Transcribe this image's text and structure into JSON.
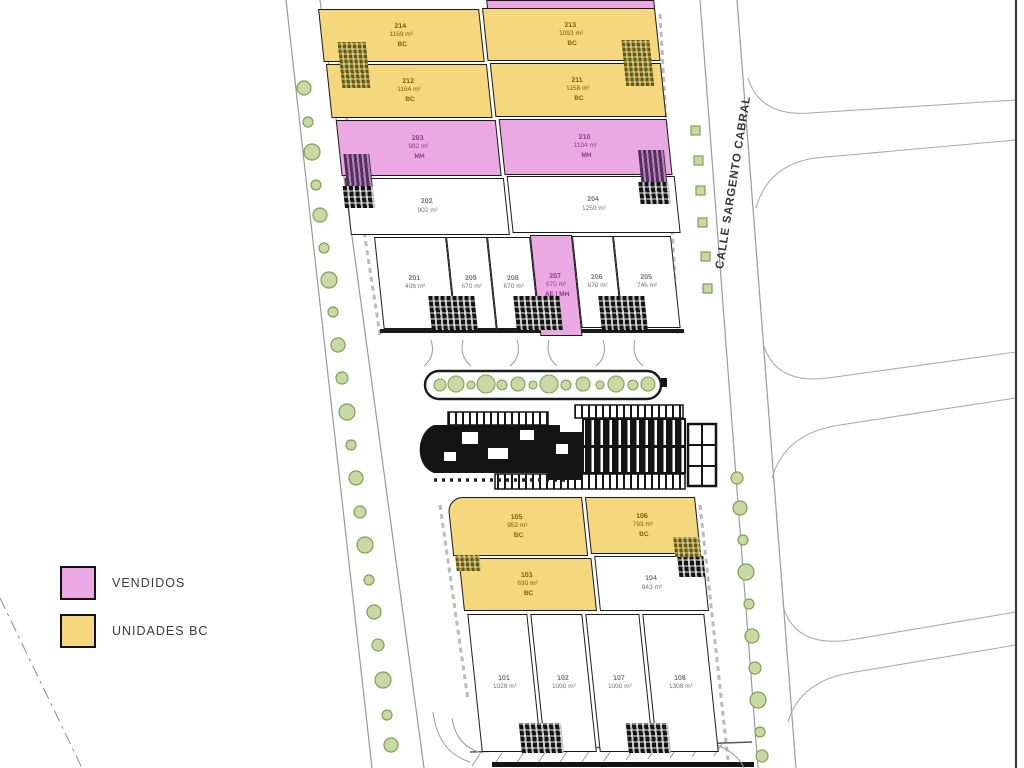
{
  "legend": {
    "items": [
      {
        "label": "VENDIDOS",
        "color": "#EAA9E3"
      },
      {
        "label": "UNIDADES BC",
        "color": "#F5D87D"
      }
    ]
  },
  "streets": {
    "calle": "CALLE SARGENTO CABRAL"
  },
  "colors": {
    "sold": "#EAA9E3",
    "bc_unit": "#F5D87D",
    "tree": "#C9D9A4",
    "line": "#999999"
  },
  "north": {
    "yellow_top": [
      {
        "number": "214",
        "area": "1169 m²",
        "cls": "BC"
      },
      {
        "number": "213",
        "area": "1093 m²",
        "cls": "BC"
      }
    ],
    "yellow_mid": [
      {
        "number": "212",
        "area": "1164 m²",
        "cls": "BC"
      },
      {
        "number": "211",
        "area": "1158 m²",
        "cls": "BC"
      }
    ],
    "pink": [
      {
        "number": "203",
        "area": "982 m²",
        "cls": "MH"
      },
      {
        "number": "210",
        "area": "1104 m²",
        "cls": "MH"
      }
    ],
    "white": [
      {
        "number": "202",
        "area": "902 m²"
      },
      {
        "number": "204",
        "area": "1250 m²"
      }
    ],
    "small": [
      {
        "number": "201",
        "area": "408 m²"
      },
      {
        "number": "209",
        "area": "670 m²"
      },
      {
        "number": "208",
        "area": "670 m²"
      },
      {
        "number": "207",
        "area": "670 m²",
        "cls": "AE / MH"
      },
      {
        "number": "206",
        "area": "670 m²"
      },
      {
        "number": "205",
        "area": "746 m²"
      }
    ]
  },
  "south": {
    "yellow_top": [
      {
        "number": "105",
        "area": "952 m²",
        "cls": "BC"
      },
      {
        "number": "106",
        "area": "793 m²",
        "cls": "BC"
      }
    ],
    "mid": [
      {
        "number": "103",
        "area": "690 m²",
        "cls": "BC"
      },
      {
        "number": "104",
        "area": "843 m²"
      }
    ],
    "bottom": [
      {
        "number": "101",
        "area": "1028 m²"
      },
      {
        "number": "102",
        "area": "1000 m²"
      },
      {
        "number": "107",
        "area": "1000 m²"
      },
      {
        "number": "108",
        "area": "1308 m²"
      }
    ]
  }
}
